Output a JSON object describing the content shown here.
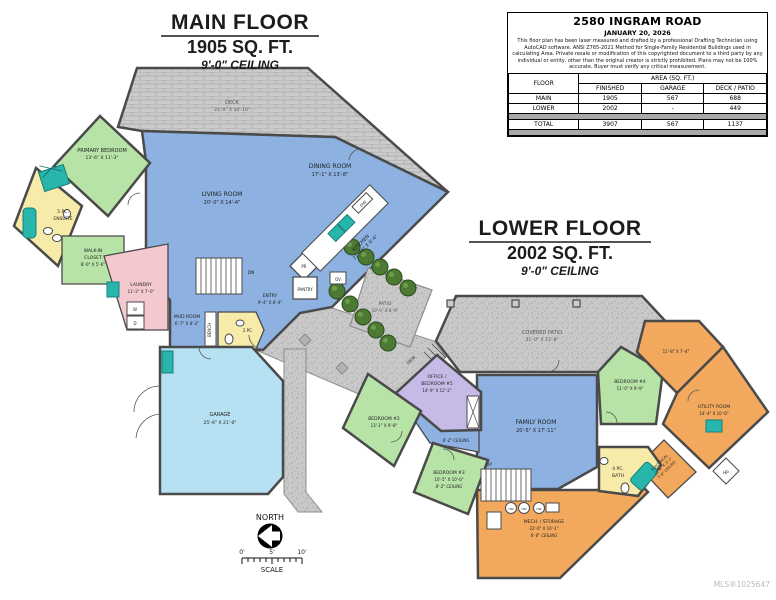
{
  "document": {
    "mls_number": "MLS®1025647"
  },
  "palette": {
    "room_blue": "#8db2e2",
    "room_green": "#b7e3a6",
    "room_yellow": "#f6eba8",
    "room_orange": "#f2a95d",
    "room_lavender": "#c6bbe7",
    "room_pink": "#f3c9cf",
    "garage_cyan": "#b5e1f2",
    "fixture_teal": "#28b5ac",
    "concrete_gray": "#c8c8c8",
    "wall_gray": "#4a4a4a",
    "tree_green": "#4c7a33"
  },
  "main_floor": {
    "title": "MAIN FLOOR",
    "area": "1905 SQ. FT.",
    "ceiling": "9'-0\" CEILING",
    "rooms": {
      "deck": {
        "name": "DECK",
        "dims": "21'-9\" X 14'-10\""
      },
      "living": {
        "name": "LIVING ROOM",
        "dims": "20'-0\" X 14'-4\""
      },
      "dining": {
        "name": "DINING ROOM",
        "dims": "17'-1\" X 13'-8\""
      },
      "kitchen": {
        "name": "KITCHEN",
        "dims": "21'-11\" X 9'-4\""
      },
      "primary": {
        "name": "PRIMARY BEDROOM",
        "dims": "13'-6\" X 11'-3\""
      },
      "ensuite": {
        "line1": "5 PC.",
        "line2": "ENSUITE"
      },
      "closet": {
        "line1": "WALK-IN",
        "line2": "CLOSET",
        "dims": "8'-0\" X 5'-6\""
      },
      "laundry": {
        "name": "LAUNDRY",
        "dims": "11'-2\" X 7'-0\""
      },
      "mud": {
        "name": "MUD ROOM",
        "dims": "6'-7\" X 8'-2\""
      },
      "entry": {
        "name": "ENTRY",
        "dims": "9'-4\" X 8'-4\""
      },
      "pantry": {
        "name": "PANTRY"
      },
      "powder": {
        "name": "PR"
      },
      "bath2pc": {
        "name": "2 PC."
      },
      "garage": {
        "name": "GARAGE",
        "dims": "25'-6\" X 21'-0\""
      },
      "patio": {
        "name": "PATIO",
        "dims": "10'-0\" X 8'-9\""
      },
      "labels": {
        "dn": "DN",
        "bench": "BENCH",
        "washer": "W",
        "dryer": "D",
        "dw": "DW",
        "ov": "OV"
      }
    }
  },
  "lower_floor": {
    "title": "LOWER FLOOR",
    "area": "2002 SQ. FT.",
    "ceiling": "9'-0\" CEILING",
    "rooms": {
      "covered_patio": {
        "name": "COVERED PATIO",
        "dims": "31'-0\" X 13'-8\""
      },
      "family": {
        "name": "FAMILY ROOM",
        "dims": "20'-5\" X 17'-11\""
      },
      "office": {
        "line1": "OFFICE /",
        "line2": "BEDROOM #5",
        "dims": "14'-9\" X 12'-2\""
      },
      "bedroom2": {
        "name": "BEDROOM #2",
        "dims": "13'-1\" X 9'-8\""
      },
      "bedroom3": {
        "name": "BEDROOM #3",
        "dims": "10'-5\" X 10'-0\"",
        "ceiling": "8'-2\" CEILING"
      },
      "bedroom4": {
        "name": "BEDROOM #4",
        "dims": "11'-0\" X 9'-9\""
      },
      "upper_room_dims": "11'-8\" X 7'-4\"",
      "utility": {
        "name": "UTILITY ROOM",
        "dims": "14'-4\" X 10'-6\""
      },
      "mech": {
        "name": "MECH. / STORAGE",
        "dims": "22'-0\" X 10'-1\"",
        "ceiling": "6'-6\" CEILING"
      },
      "electrical": {
        "name": "ELECTRICAL",
        "dims": "13'-6\" X 3'-1\"",
        "ceiling": "7'-6\" CEILING"
      },
      "bath4pc": {
        "line1": "4 PC.",
        "line2": "BATH"
      },
      "hall_ceiling": "8'-2\" CEILING",
      "labels": {
        "up": "UP",
        "desk": "DESK",
        "hp": "HP",
        "hw": "HW"
      }
    }
  },
  "info_table": {
    "address": "2580 INGRAM ROAD",
    "date": "JANUARY 20, 2026",
    "disclaimer": "This floor plan has been laser measured and drafted by a professional Drafting Technician using AutoCAD software. ANSI Z765-2021 Method for Single-Family Residential Buildings used in calculating Area. Private resale or modification of this copyrighted document to a third party by any individual or entity, other than the original creator is strictly prohibited. Plans may not be 100% accurate. Buyer must verify any critical measurement.",
    "headers": {
      "floor": "FLOOR",
      "area_group": "AREA (SQ. FT.)",
      "finished": "FINISHED",
      "garage": "GARAGE",
      "deck_patio": "DECK / PATIO"
    },
    "rows": [
      {
        "floor": "MAIN",
        "finished": "1905",
        "garage": "567",
        "deck_patio": "688"
      },
      {
        "floor": "LOWER",
        "finished": "2002",
        "garage": "-",
        "deck_patio": "449"
      },
      {
        "floor": "TOTAL",
        "finished": "3907",
        "garage": "567",
        "deck_patio": "1137"
      }
    ]
  },
  "compass": {
    "north_label": "NORTH",
    "scale_label": "SCALE",
    "tick0": "0'",
    "tick5": "5'",
    "tick10": "10'"
  }
}
